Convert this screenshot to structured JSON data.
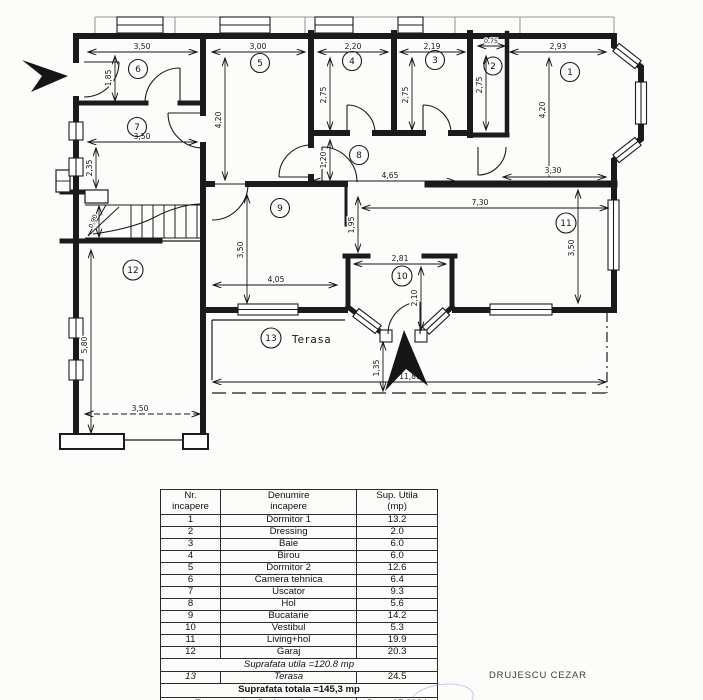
{
  "plan": {
    "room_numbers": [
      "1",
      "2",
      "3",
      "4",
      "5",
      "6",
      "7",
      "8",
      "9",
      "10",
      "11",
      "12",
      "13"
    ],
    "terasa_label": "Terasa",
    "dims": {
      "r6w": "3,50",
      "r6h": "1,85",
      "r7w": "3,50",
      "r7h": "2,35",
      "r5w": "3,00",
      "r5h": "4,20",
      "r4w": "2,20",
      "r4h": "2,75",
      "r3w": "2,19",
      "r3h": "2,75",
      "r2w": "0,75",
      "r2h": "2,75",
      "r1w": "2,93",
      "r1h": "4,20",
      "r1b": "3,30",
      "r8h": "1,20",
      "r8w": "4,65",
      "r9w": "4,05",
      "r9h": "3,50",
      "r9p": "1,95",
      "r11w": "7,30",
      "r11h": "3,50",
      "r10w": "2,81",
      "r10h": "2,10",
      "entry": "1,35",
      "total_w": "11,81",
      "r12h": "5,80",
      "r12w": "3,50",
      "stair": "0,90"
    }
  },
  "table": {
    "headers": {
      "nr1": "Nr.",
      "nr2": "incapere",
      "name1": "Denumire",
      "name2": "incapere",
      "sup1": "Sup. Utila",
      "sup2": "(mp)"
    },
    "rows": [
      {
        "nr": "1",
        "name": "Dormitor 1",
        "sup": "13.2"
      },
      {
        "nr": "2",
        "name": "Dressing",
        "sup": "2.0"
      },
      {
        "nr": "3",
        "name": "Baie",
        "sup": "6.0"
      },
      {
        "nr": "4",
        "name": "Birou",
        "sup": "6.0"
      },
      {
        "nr": "5",
        "name": "Dormitor 2",
        "sup": "12.6"
      },
      {
        "nr": "6",
        "name": "Camera tehnica",
        "sup": "6.4"
      },
      {
        "nr": "7",
        "name": "Uscator",
        "sup": "9.3"
      },
      {
        "nr": "8",
        "name": "Hol",
        "sup": "5.6"
      },
      {
        "nr": "9",
        "name": "Bucatarie",
        "sup": "14.2"
      },
      {
        "nr": "10",
        "name": "Vestibul",
        "sup": "5.3"
      },
      {
        "nr": "11",
        "name": "Living+hol",
        "sup": "19.9"
      },
      {
        "nr": "12",
        "name": "Garaj",
        "sup": "20.3"
      }
    ],
    "subtotal": "Suprafata utila =120.8  mp",
    "terasa_row": {
      "nr": "13",
      "name": "Terasa",
      "sup": "24.5"
    },
    "total": "Suprafata totala =145,3 mp",
    "executant": "Executant :ing.Drujescu Cezar",
    "data_label": "Data: 07.2024"
  },
  "footer": {
    "signature": "DRUJESCU CEZAR"
  }
}
